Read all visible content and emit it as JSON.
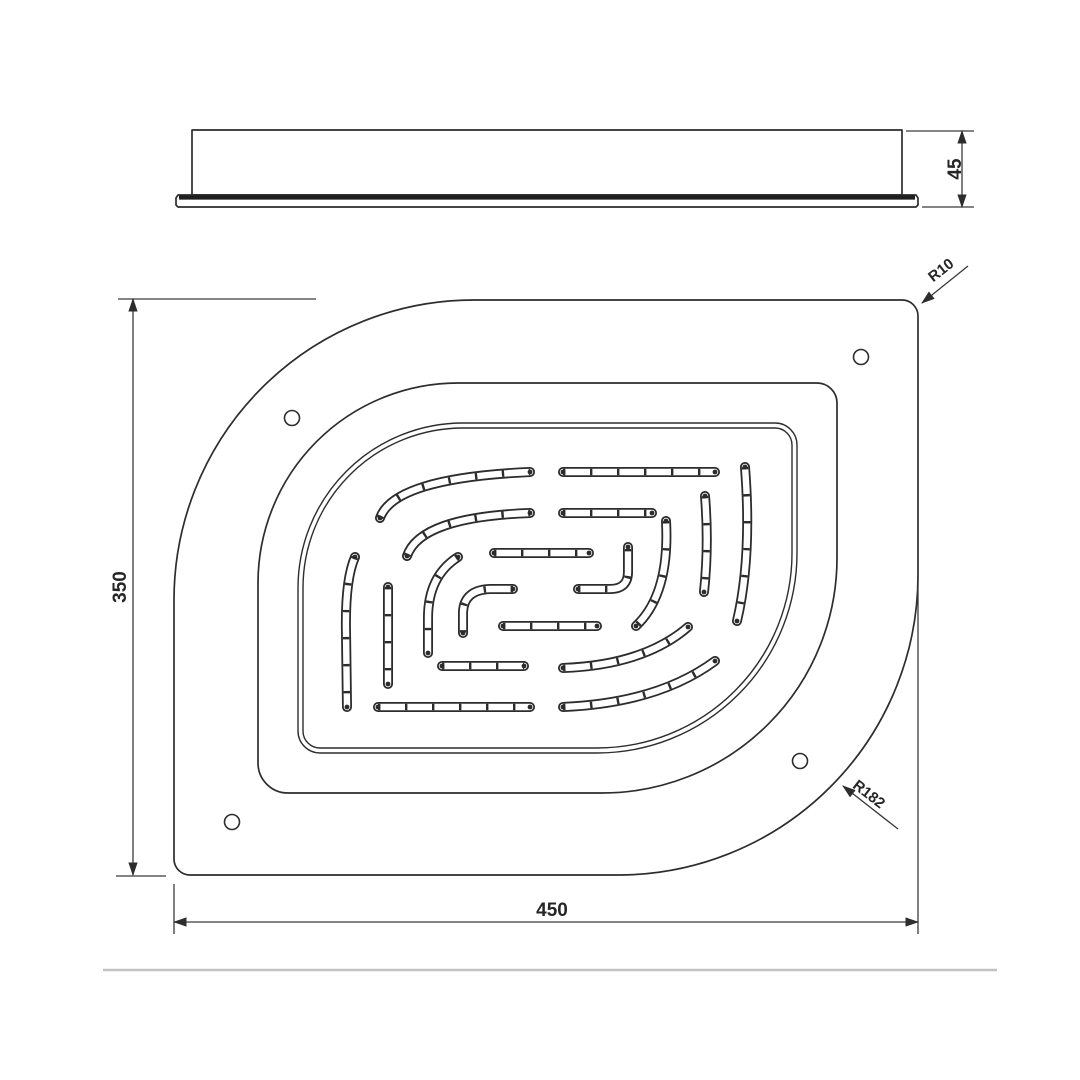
{
  "drawing": {
    "kind": "technical-drawing",
    "dimensions": {
      "side_thickness": "45",
      "plan_height": "350",
      "plan_width": "450",
      "radius_small": "R10",
      "radius_large": "R182"
    },
    "colors": {
      "line": "#2d2d2d",
      "dim": "#3a3a3a",
      "separator": "#c2c2c2",
      "background": "#ffffff"
    }
  },
  "geometry": {
    "side_view": {
      "body": "M192 130 L902 130 L902 195 L192 195 Z",
      "flange": "M178 195 L916 195 L918 198 L918 205 L916 207 L178 207 L176 205 L176 198 Z",
      "flange_top_edge": "M179 197.5 L915 197.5"
    },
    "plan_view": {
      "outer": "M174 600 A300 300 0 0 1 474 300 L902 300 A16 16 0 0 1 918 316 L918 575 A300 300 0 0 1 618 875 L190 875 A16 16 0 0 1 174 859 Z",
      "mid": "M258 583 A200 200 0 0 1 458 383 L817 383 A20 20 0 0 1 837 403 L837 558 A235 235 0 0 1 602 793 L288 793 A30 30 0 0 1 258 763 Z",
      "panel_outer": "M298 588 A165 165 0 0 1 463 423 L775 423 A22 22 0 0 1 797 445 L797 553 A200 200 0 0 1 597 753 L320 753 A22 22 0 0 1 298 731 Z",
      "panel_inner": "M303 588 A160 160 0 0 1 463 428 L775 428 A17 17 0 0 1 792 445 L792 553 A195 195 0 0 1 597 748 L320 748 A17 17 0 0 1 303 731 Z",
      "holes": [
        "M284.5 418 A7.5 7.5 0 1 0 299.5 418 A7.5 7.5 0 1 0 284.5 418 Z",
        "M853.5 357 A7.5 7.5 0 1 0 868.5 357 A7.5 7.5 0 1 0 853.5 357 Z",
        "M224.5 822 A7.5 7.5 0 1 0 239.5 822 A7.5 7.5 0 1 0 224.5 822 Z",
        "M792.5 761 A7.5 7.5 0 1 0 807.5 761 A7.5 7.5 0 1 0 792.5 761 Z"
      ]
    },
    "slots": [
      "M380 518 Q394 478 530 472",
      "M563 472 L715 472",
      "M407 556 Q420 517 530 513",
      "M563 513 L652 513",
      "M494 553 L589 553",
      "M578 589 L610 589 Q628 589 628 572 L628 547",
      "M666 521 Q670 594 636 626",
      "M705 496 Q709 545 704 592",
      "M745 467 Q752 557 737 621",
      "M355 557 Q345 580 346 632 L347 707",
      "M388 587 L388 684",
      "M458 557 Q428 576 428 618 L428 653",
      "M513 589 L490 589 Q464 590 463 612 L463 633",
      "M503 626 L597 626",
      "M442 666 L524 666",
      "M563 668 Q644 665 688 627",
      "M378 707 L530 707",
      "M563 707 Q658 703 715 661"
    ],
    "dim_lines": {
      "thickness": "M962 131 L962 207",
      "height": "M133 299 L133 875",
      "width": "M174 922 L918 922"
    },
    "ext_lines": [
      "M906 131 L974 131",
      "M922 207 L974 207",
      "M118 299 L316 299",
      "M116 876 L166 876",
      "M174 884 L174 934",
      "M918 578 L918 934"
    ],
    "leaders": {
      "radius_small": "M922 303 L968 266",
      "radius_large": "M843 786 L898 829"
    },
    "separator": "M103 970 L997 970"
  }
}
